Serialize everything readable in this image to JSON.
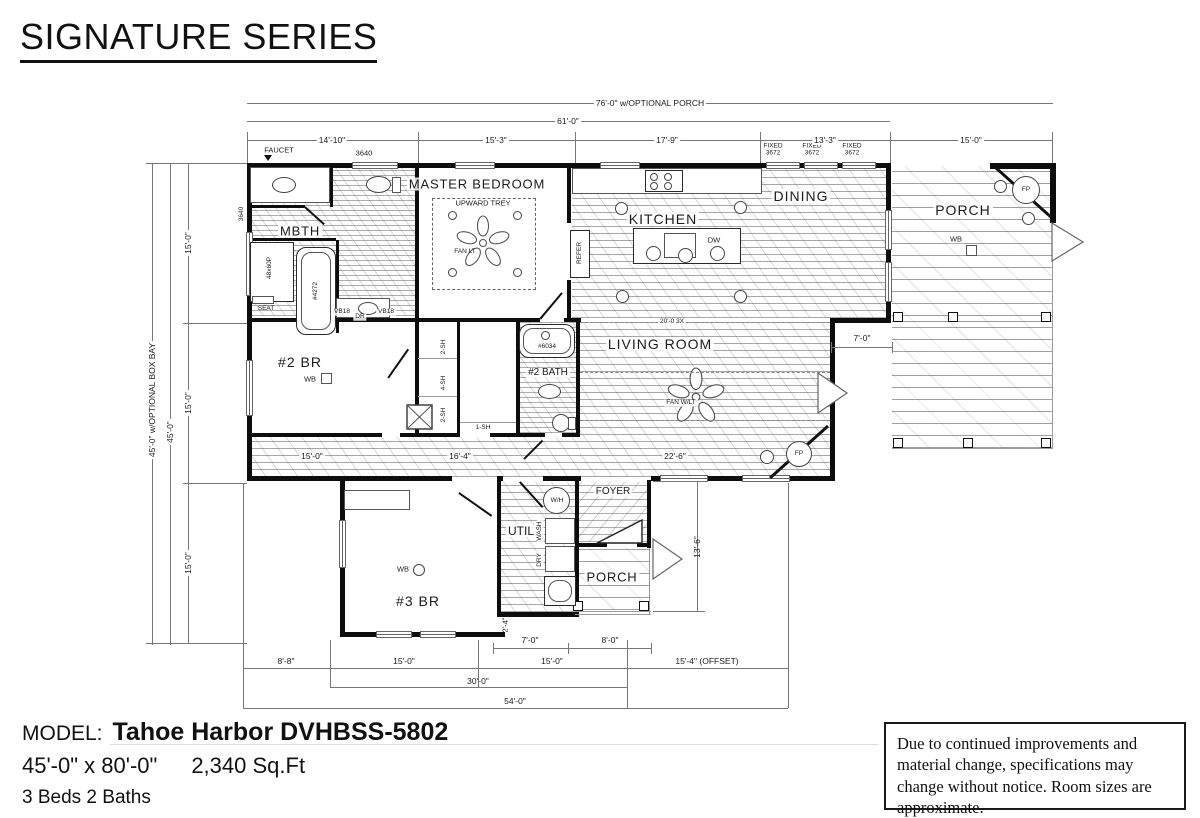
{
  "title": "SIGNATURE SERIES",
  "footer": {
    "model_label": "MODEL:",
    "model_name": "Tahoe Harbor DVHBSS-5802",
    "size": "45'-0\" x 80'-0\"",
    "sqft": "2,340 Sq.Ft",
    "beds_baths": "3 Beds 2 Baths"
  },
  "disclaimer": "Due to continued improvements and material change, specifications may change without notice. Room sizes are approximate.",
  "rooms": {
    "mbth": "MBTH",
    "master": "MASTER BEDROOM",
    "kitchen": "KITCHEN",
    "dining": "DINING",
    "porch": "PORCH",
    "br2": "#2 BR",
    "bath2": "#2 BATH",
    "living": "LIVING ROOM",
    "foyer": "FOYER",
    "util": "UTIL",
    "br3": "#3 BR",
    "porch2": "PORCH"
  },
  "dims": {
    "top_overall": "76'-0\" w/OPTIONAL PORCH",
    "top_main": "61'-0\"",
    "top_segs": [
      "14'-10\"",
      "15'-3\"",
      "17'-9\"",
      "13'-3\"",
      "15'-0\""
    ],
    "left_overall": "45'-0\" w/OPTIONAL BOX BAY",
    "left_main": "45'-0\"",
    "left_segs": [
      "15'-0\"",
      "15'-0\"",
      "15'-0\""
    ],
    "offset": "7'-0\"",
    "porch_side": "13'-6\"",
    "jog": "2'-4\"",
    "util_w": "7'-0\"",
    "porch_w": "8'-0\"",
    "bottom_segs": [
      "8'-8\"",
      "15'-0\"",
      "15'-0\"",
      "15'-4\" (OFFSET)"
    ],
    "bottom_mid": "30'-0\"",
    "bottom_total": "54'-0\"",
    "hall_a": "15'-0\"",
    "hall_b": "16'-4\"",
    "living_w": "22'-6\""
  },
  "labels": {
    "faucet": "FAUCET",
    "win3640": "3640",
    "fixed": "FIXED",
    "fixed_size": "3672",
    "refer": "REFER",
    "dw": "DW",
    "upward_trey": "UPWARD TREY",
    "fan1": "FAN LT",
    "fan2": "FAN W/LT",
    "wb": "WB",
    "fp": "FP",
    "seat": "SEAT",
    "shower": "48x60P",
    "tub_master": "#4272",
    "tub_2": "#6034",
    "vb18": "VB18",
    "dr": "DR",
    "sh2": "2-SH",
    "sh4": "4-SH",
    "sh1": "1-SH",
    "wh": "W/H",
    "dry": "DRY",
    "wash": "WASH",
    "beam": "20'-0 3X"
  }
}
